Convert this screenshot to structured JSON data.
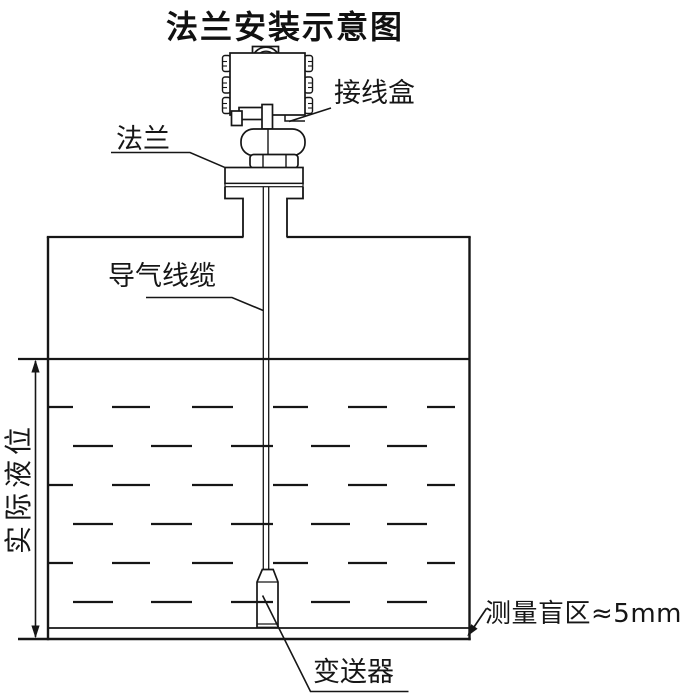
{
  "title": "法兰安装示意图",
  "labels": {
    "junction_box": "接线盒",
    "flange": "法兰",
    "air_cable": "导气线缆",
    "actual_level": "实际液位",
    "blind_zone": "测量盲区≈5mm",
    "transmitter": "变送器"
  },
  "colors": {
    "line": "#161616",
    "background": "#ffffff"
  }
}
